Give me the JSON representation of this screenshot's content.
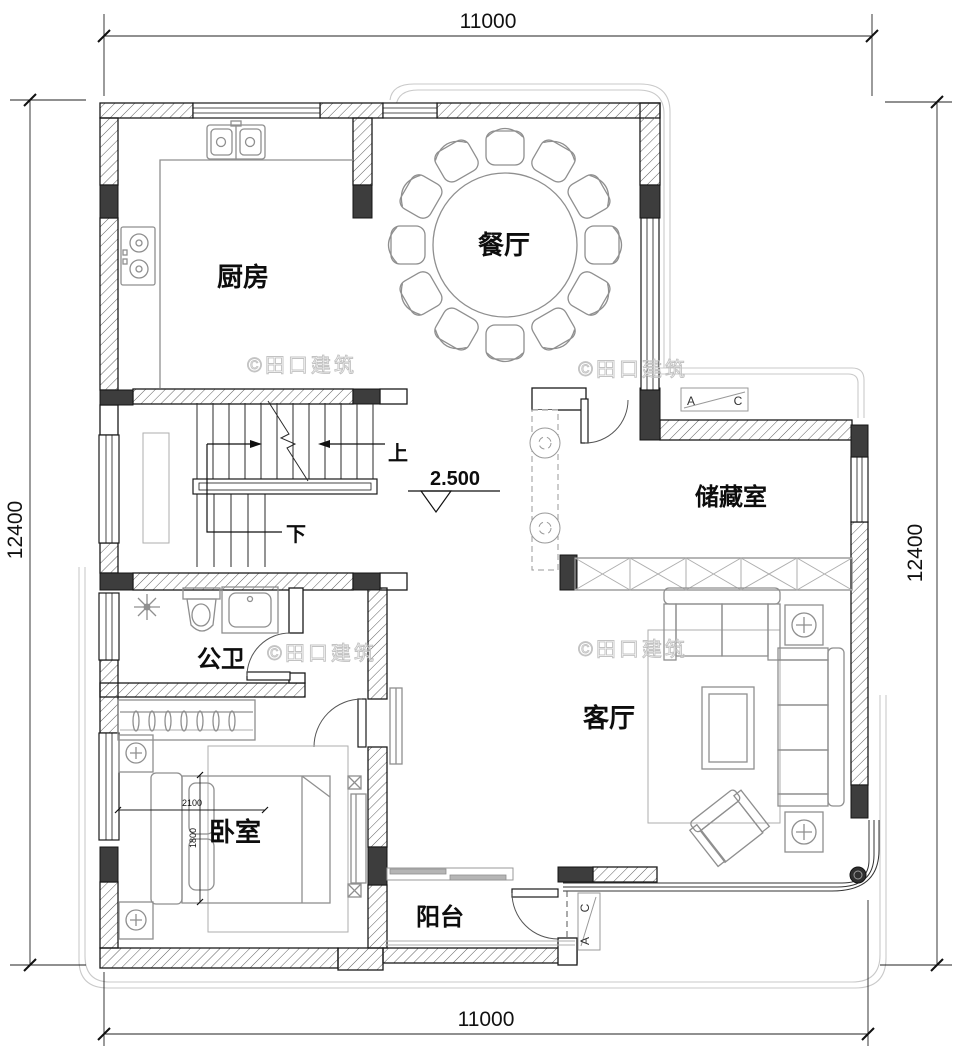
{
  "plan": {
    "watermark_text": "©田口建筑",
    "level_label": "2.500",
    "dim_width": "11000",
    "dim_height": "12400",
    "rooms": {
      "kitchen": "厨房",
      "dining": "餐厅",
      "storage": "储藏室",
      "bathroom": "公卫",
      "living": "客厅",
      "bedroom": "卧室",
      "balcony": "阳台"
    },
    "stairs": {
      "up": "上",
      "down": "下"
    },
    "bed": {
      "length": "2100",
      "width": "1800"
    },
    "section_marker": {
      "a": "A",
      "c": "C"
    },
    "colors": {
      "wall_line": "#1a1a1a",
      "column_fill": "#3d3d3d",
      "furniture_line": "#8f8f8f",
      "eave_line": "#c9c9c9",
      "watermark": "#c2c2c2",
      "background": "#ffffff"
    }
  }
}
